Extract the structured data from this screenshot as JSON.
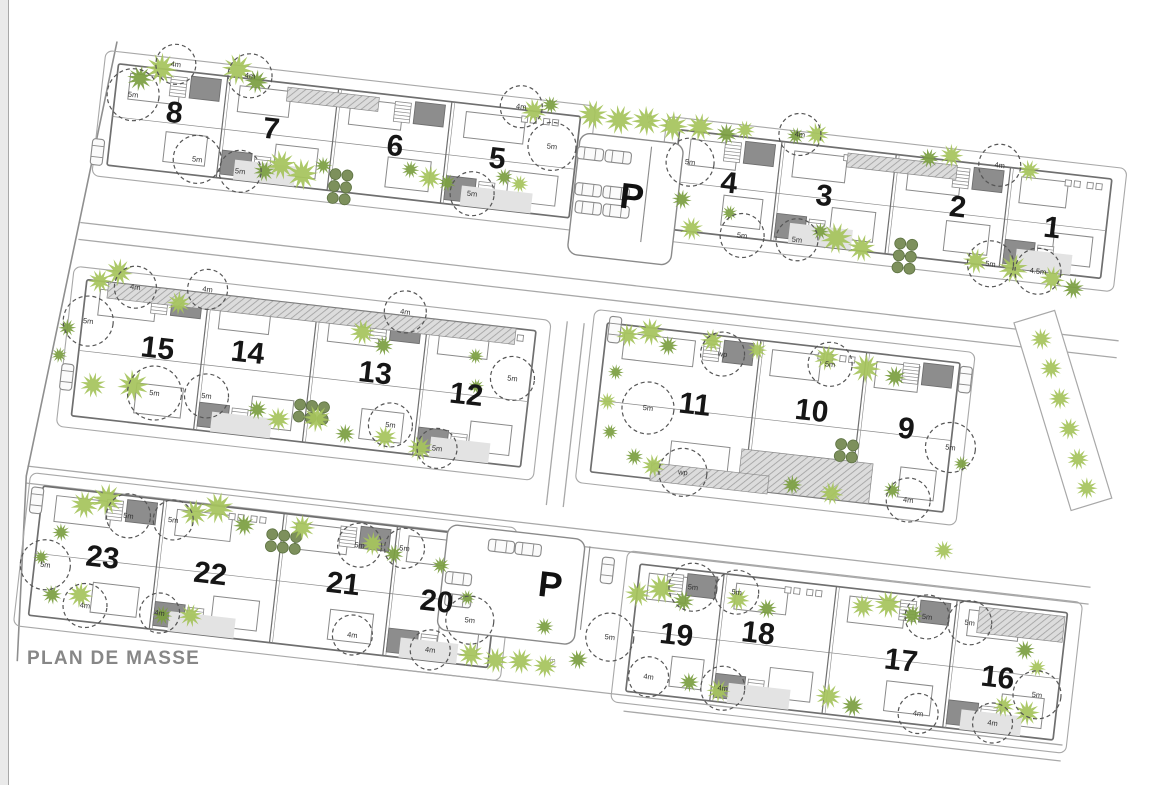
{
  "title": "PLAN DE MASSE",
  "labels": {
    "parking": "P",
    "ev": "EV"
  },
  "colors": {
    "outline": "#8a8a8a",
    "outline_dark": "#6f6f6f",
    "slab_fill": "#ffffff",
    "patch": "#8d8d8d",
    "court": "#e3e3e3",
    "road": "#a8a8a8",
    "tree_light": "#a6c45c",
    "tree_dark": "#7c9f42",
    "bush": "#7d905c",
    "bush_edge": "#5d7242",
    "number": "#161616",
    "measure": "#333333",
    "title": "#878787",
    "boundary": "#8f8f8f",
    "hatch_bg": "#dcdcdc",
    "hatch_ln": "#9f9f9f"
  },
  "plan": {
    "rotation_deg": 6.5,
    "slabs": [
      {
        "x": 125,
        "y": 50,
        "w": 465,
        "h": 102,
        "units": [
          [
            "8",
            186,
            92
          ],
          [
            "7",
            284,
            97
          ],
          [
            "6",
            409,
            100
          ],
          [
            "5",
            512,
            101
          ]
        ]
      },
      {
        "x": 690,
        "y": 52,
        "w": 435,
        "h": 100,
        "units": [
          [
            "4",
            745,
            99
          ],
          [
            "3",
            841,
            101
          ],
          [
            "2",
            975,
            97
          ],
          [
            "1",
            1071,
            107
          ]
        ]
      },
      {
        "x": 118,
        "y": 268,
        "w": 452,
        "h": 137,
        "units": [
          [
            "15",
            196,
            328
          ],
          [
            "14",
            286,
            322
          ],
          [
            "13",
            415,
            328
          ],
          [
            "12",
            508,
            339
          ]
        ]
      },
      {
        "x": 640,
        "y": 252,
        "w": 355,
        "h": 150,
        "units": [
          [
            "11",
            736,
            323
          ],
          [
            "10",
            853,
            316
          ],
          [
            "9",
            949,
            323
          ]
        ]
      },
      {
        "x": 98,
        "y": 478,
        "w": 462,
        "h": 130,
        "units": [
          [
            "23",
            165,
            542
          ],
          [
            "22",
            274,
            546
          ],
          [
            "21",
            407,
            541
          ],
          [
            "20",
            502,
            548
          ]
        ]
      },
      {
        "x": 700,
        "y": 488,
        "w": 430,
        "h": 128,
        "units": [
          [
            "19",
            744,
            554
          ],
          [
            "18",
            825,
            543
          ],
          [
            "17",
            970,
            554
          ],
          [
            "16",
            1068,
            560
          ]
        ]
      }
    ],
    "parkings": [
      {
        "label": "P",
        "lx": 650,
        "ly": 124,
        "outline": [
          592,
          66,
          104,
          122
        ],
        "lane": [
          664,
          72,
          664,
          168
        ],
        "cars": [
          [
            604,
            86
          ],
          [
            632,
            86
          ],
          [
            606,
            122
          ],
          [
            634,
            122
          ],
          [
            608,
            140
          ],
          [
            636,
            140
          ]
        ]
      },
      {
        "label": "P",
        "lx": 613,
        "ly": 519,
        "outline": [
          505,
          470,
          138,
          106
        ],
        "lane": [
          648,
          476,
          648,
          560
        ],
        "cars": [
          [
            560,
            486
          ],
          [
            587,
            486
          ],
          [
            521,
            523
          ],
          [
            523,
            545
          ]
        ]
      }
    ],
    "cars_extra": [
      [
        114,
        140
      ],
      [
        109,
        367
      ],
      [
        93,
        493
      ],
      [
        1002,
        268
      ],
      [
        668,
        498
      ],
      [
        648,
        258
      ]
    ],
    "ev_labels": [
      [
        657,
        46
      ],
      [
        622,
        597
      ]
    ],
    "roads": [
      [
        105,
        212,
        1150,
        212
      ],
      [
        105,
        229,
        1150,
        229
      ],
      [
        80,
        460,
        1150,
        460
      ],
      [
        80,
        477,
        1150,
        477
      ],
      [
        430,
        620,
        1140,
        620
      ],
      [
        700,
        636,
        1140,
        636
      ],
      [
        600,
        255,
        600,
        440
      ],
      [
        617,
        255,
        617,
        440
      ]
    ],
    "boundary": [
      [
        121,
        28
      ],
      [
        80,
        470
      ],
      [
        92,
        655
      ]
    ],
    "right_strip": {
      "poly": [
        [
          1083,
          189
        ],
        [
          1161,
          369
        ],
        [
          1122,
          386
        ],
        [
          1044,
          206
        ]
      ],
      "trees": [
        [
          1073,
          219
        ],
        [
          1086,
          247
        ],
        [
          1098,
          276
        ],
        [
          1111,
          305
        ],
        [
          1123,
          334
        ],
        [
          1135,
          362
        ]
      ]
    },
    "hatches": [
      [
        296,
        54,
        92,
        14
      ],
      [
        860,
        56,
        110,
        14
      ],
      [
        140,
        268,
        410,
        16
      ],
      [
        788,
        362,
        132,
        40
      ],
      [
        700,
        386,
        118,
        18
      ],
      [
        1042,
        492,
        86,
        26
      ]
    ],
    "bush_grids": [
      [
        353,
        135,
        2,
        3
      ],
      [
        922,
        140,
        2,
        3
      ],
      [
        344,
        368,
        3,
        2
      ],
      [
        331,
        500,
        3,
        2
      ],
      [
        886,
        346,
        2,
        2
      ]
    ],
    "circles": [
      [
        143,
        79,
        26,
        "5m"
      ],
      [
        182,
        44,
        20,
        "4m"
      ],
      [
        257,
        47,
        22,
        "4m"
      ],
      [
        214,
        136,
        24,
        "5m"
      ],
      [
        258,
        143,
        21,
        "5m"
      ],
      [
        530,
        47,
        21,
        "4m"
      ],
      [
        565,
        83,
        24,
        "5m"
      ],
      [
        491,
        139,
        22,
        "5m"
      ],
      [
        704,
        83,
        24,
        "5m"
      ],
      [
        810,
        43,
        21,
        "4m"
      ],
      [
        764,
        150,
        22,
        "5m"
      ],
      [
        819,
        148,
        21,
        "5m"
      ],
      [
        1012,
        51,
        21,
        "4m"
      ],
      [
        1014,
        150,
        23,
        "5m"
      ],
      [
        1062,
        152,
        23,
        "4.5m"
      ],
      [
        167,
        270,
        21,
        "4m"
      ],
      [
        124,
        309,
        25,
        "5m"
      ],
      [
        239,
        264,
        20,
        "4m"
      ],
      [
        438,
        264,
        21,
        "4m"
      ],
      [
        198,
        373,
        27,
        "5m"
      ],
      [
        250,
        370,
        22,
        "5m"
      ],
      [
        436,
        378,
        22,
        "5m"
      ],
      [
        485,
        396,
        20,
        "5m"
      ],
      [
        552,
        318,
        22,
        "5m"
      ],
      [
        690,
        332,
        26,
        "5m"
      ],
      [
        732,
        392,
        24,
        "wp"
      ],
      [
        758,
        270,
        22,
        "wp"
      ],
      [
        866,
        268,
        22,
        "5m"
      ],
      [
        995,
        337,
        25,
        "5m"
      ],
      [
        959,
        394,
        22,
        "4m"
      ],
      [
        109,
        556,
        25,
        "5m"
      ],
      [
        186,
        498,
        22,
        "5m"
      ],
      [
        231,
        497,
        20,
        "5m"
      ],
      [
        153,
        592,
        22,
        "4m"
      ],
      [
        228,
        591,
        20,
        "4m"
      ],
      [
        419,
        501,
        22,
        "5m"
      ],
      [
        464,
        499,
        20,
        "5m"
      ],
      [
        422,
        591,
        20,
        "4m"
      ],
      [
        537,
        563,
        24,
        "5m"
      ],
      [
        501,
        597,
        20,
        "4m"
      ],
      [
        678,
        564,
        24,
        "5m"
      ],
      [
        721,
        599,
        20,
        "4m"
      ],
      [
        755,
        505,
        24,
        "5m"
      ],
      [
        799,
        505,
        22,
        "5m"
      ],
      [
        796,
        602,
        22,
        "4m"
      ],
      [
        991,
        508,
        22,
        "5m"
      ],
      [
        1034,
        509,
        22,
        "5m"
      ],
      [
        1109,
        573,
        24,
        "5m"
      ],
      [
        993,
        605,
        20,
        "4m"
      ],
      [
        1068,
        606,
        20,
        "4m"
      ]
    ],
    "trees": [
      [
        148,
        62,
        13,
        "d"
      ],
      [
        168,
        50,
        16,
        "l"
      ],
      [
        244,
        42,
        16,
        "l"
      ],
      [
        264,
        52,
        12,
        "d"
      ],
      [
        282,
        140,
        11,
        "d"
      ],
      [
        298,
        132,
        15,
        "l"
      ],
      [
        320,
        139,
        16,
        "l"
      ],
      [
        340,
        128,
        9,
        "d"
      ],
      [
        427,
        122,
        9,
        "d"
      ],
      [
        447,
        128,
        12,
        "l"
      ],
      [
        465,
        131,
        9,
        "d"
      ],
      [
        521,
        119,
        9,
        "d"
      ],
      [
        537,
        124,
        9,
        "l"
      ],
      [
        543,
        50,
        13,
        "l"
      ],
      [
        559,
        42,
        9,
        "d"
      ],
      [
        602,
        47,
        15,
        "l"
      ],
      [
        629,
        49,
        15,
        "l"
      ],
      [
        656,
        47,
        15,
        "l"
      ],
      [
        683,
        49,
        15,
        "l"
      ],
      [
        710,
        47,
        14,
        "l"
      ],
      [
        737,
        51,
        11,
        "d"
      ],
      [
        755,
        45,
        10,
        "l"
      ],
      [
        700,
        121,
        10,
        "d"
      ],
      [
        713,
        149,
        12,
        "l"
      ],
      [
        749,
        129,
        8,
        "d"
      ],
      [
        806,
        45,
        9,
        "d"
      ],
      [
        827,
        41,
        12,
        "l"
      ],
      [
        858,
        142,
        16,
        "l"
      ],
      [
        884,
        149,
        14,
        "l"
      ],
      [
        841,
        137,
        9,
        "d"
      ],
      [
        941,
        52,
        10,
        "d"
      ],
      [
        963,
        47,
        12,
        "l"
      ],
      [
        1042,
        53,
        11,
        "l"
      ],
      [
        999,
        149,
        13,
        "l"
      ],
      [
        1037,
        152,
        15,
        "l"
      ],
      [
        1077,
        158,
        13,
        "l"
      ],
      [
        1099,
        165,
        11,
        "d"
      ],
      [
        131,
        268,
        12,
        "l"
      ],
      [
        149,
        257,
        14,
        "l"
      ],
      [
        212,
        281,
        12,
        "l"
      ],
      [
        398,
        289,
        13,
        "l"
      ],
      [
        420,
        300,
        10,
        "d"
      ],
      [
        104,
        318,
        9,
        "d"
      ],
      [
        99,
        346,
        8,
        "d"
      ],
      [
        136,
        372,
        13,
        "l"
      ],
      [
        176,
        368,
        16,
        "l"
      ],
      [
        302,
        378,
        10,
        "d"
      ],
      [
        324,
        385,
        12,
        "l"
      ],
      [
        362,
        380,
        14,
        "l"
      ],
      [
        392,
        392,
        10,
        "d"
      ],
      [
        432,
        391,
        12,
        "l"
      ],
      [
        468,
        398,
        13,
        "l"
      ],
      [
        513,
        300,
        8,
        "d"
      ],
      [
        517,
        330,
        8,
        "d"
      ],
      [
        662,
        262,
        12,
        "l"
      ],
      [
        684,
        256,
        14,
        "l"
      ],
      [
        703,
        268,
        10,
        "d"
      ],
      [
        746,
        258,
        12,
        "l"
      ],
      [
        792,
        262,
        10,
        "l"
      ],
      [
        862,
        262,
        13,
        "l"
      ],
      [
        902,
        268,
        15,
        "l"
      ],
      [
        932,
        273,
        11,
        "d"
      ],
      [
        654,
        300,
        8,
        "d"
      ],
      [
        649,
        330,
        9,
        "l"
      ],
      [
        655,
        360,
        8,
        "d"
      ],
      [
        682,
        382,
        9,
        "d"
      ],
      [
        702,
        389,
        12,
        "l"
      ],
      [
        842,
        392,
        10,
        "d"
      ],
      [
        882,
        396,
        12,
        "l"
      ],
      [
        942,
        386,
        9,
        "d"
      ],
      [
        1000,
        440,
        10,
        "l"
      ],
      [
        1008,
        352,
        8,
        "d"
      ],
      [
        141,
        492,
        14,
        "l"
      ],
      [
        163,
        484,
        16,
        "l"
      ],
      [
        121,
        522,
        9,
        "d"
      ],
      [
        104,
        549,
        8,
        "d"
      ],
      [
        119,
        585,
        10,
        "d"
      ],
      [
        147,
        582,
        13,
        "l"
      ],
      [
        251,
        488,
        14,
        "l"
      ],
      [
        274,
        480,
        16,
        "l"
      ],
      [
        302,
        494,
        11,
        "d"
      ],
      [
        360,
        490,
        13,
        "l"
      ],
      [
        231,
        593,
        10,
        "d"
      ],
      [
        259,
        590,
        12,
        "l"
      ],
      [
        432,
        498,
        12,
        "l"
      ],
      [
        454,
        506,
        10,
        "d"
      ],
      [
        502,
        512,
        9,
        "d"
      ],
      [
        532,
        541,
        8,
        "d"
      ],
      [
        542,
        597,
        13,
        "l"
      ],
      [
        567,
        600,
        13,
        "l"
      ],
      [
        592,
        598,
        13,
        "l"
      ],
      [
        617,
        600,
        12,
        "l"
      ],
      [
        649,
        590,
        10,
        "d"
      ],
      [
        612,
        561,
        9,
        "d"
      ],
      [
        701,
        518,
        13,
        "l"
      ],
      [
        724,
        510,
        15,
        "l"
      ],
      [
        747,
        520,
        11,
        "d"
      ],
      [
        801,
        512,
        12,
        "l"
      ],
      [
        831,
        518,
        10,
        "d"
      ],
      [
        926,
        505,
        12,
        "l"
      ],
      [
        951,
        500,
        14,
        "l"
      ],
      [
        976,
        508,
        11,
        "d"
      ],
      [
        762,
        600,
        10,
        "d"
      ],
      [
        792,
        605,
        12,
        "l"
      ],
      [
        902,
        598,
        13,
        "l"
      ],
      [
        927,
        605,
        11,
        "d"
      ],
      [
        1092,
        530,
        10,
        "d"
      ],
      [
        1106,
        546,
        9,
        "l"
      ],
      [
        1077,
        588,
        11,
        "l"
      ],
      [
        1101,
        592,
        13,
        "l"
      ]
    ]
  }
}
